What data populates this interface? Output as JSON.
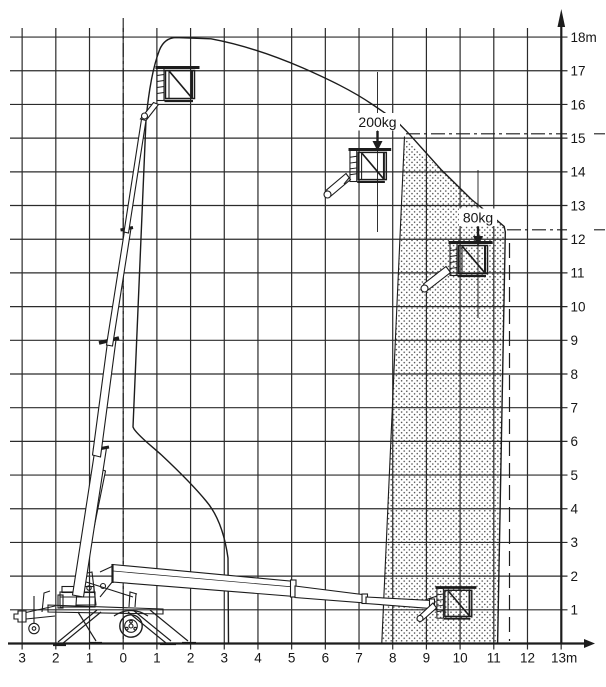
{
  "colors": {
    "ink": "#1c1c1c",
    "grid": "#2b2b2b",
    "background": "#ffffff",
    "dots": "#3c3c3c"
  },
  "y_axis": {
    "ticks": [
      {
        "label": "18m",
        "h": 18
      },
      {
        "label": "17",
        "h": 17
      },
      {
        "label": "16",
        "h": 16
      },
      {
        "label": "15",
        "h": 15
      },
      {
        "label": "14",
        "h": 14
      },
      {
        "label": "13",
        "h": 13
      },
      {
        "label": "12",
        "h": 12
      },
      {
        "label": "11",
        "h": 11
      },
      {
        "label": "10",
        "h": 10
      },
      {
        "label": "9",
        "h": 9
      },
      {
        "label": "8",
        "h": 8
      },
      {
        "label": "7",
        "h": 7
      },
      {
        "label": "6",
        "h": 6
      },
      {
        "label": "5",
        "h": 5
      },
      {
        "label": "4",
        "h": 4
      },
      {
        "label": "3",
        "h": 3
      },
      {
        "label": "2",
        "h": 2
      },
      {
        "label": "1",
        "h": 1
      }
    ]
  },
  "x_axis": {
    "ticks": [
      {
        "label": "3",
        "m": -3
      },
      {
        "label": "2",
        "m": -2
      },
      {
        "label": "1",
        "m": -1
      },
      {
        "label": "0",
        "m": 0
      },
      {
        "label": "1",
        "m": 1
      },
      {
        "label": "2",
        "m": 2
      },
      {
        "label": "3",
        "m": 3
      },
      {
        "label": "4",
        "m": 4
      },
      {
        "label": "5",
        "m": 5
      },
      {
        "label": "6",
        "m": 6
      },
      {
        "label": "7",
        "m": 7
      },
      {
        "label": "8",
        "m": 8
      },
      {
        "label": "9",
        "m": 9
      },
      {
        "label": "10",
        "m": 10
      },
      {
        "label": "11",
        "m": 11
      },
      {
        "label": "12",
        "m": 12
      },
      {
        "label": "13m",
        "m": 13
      }
    ]
  },
  "annotations": {
    "upper_load": {
      "label": "200kg"
    },
    "lower_load": {
      "label": "80kg"
    }
  }
}
